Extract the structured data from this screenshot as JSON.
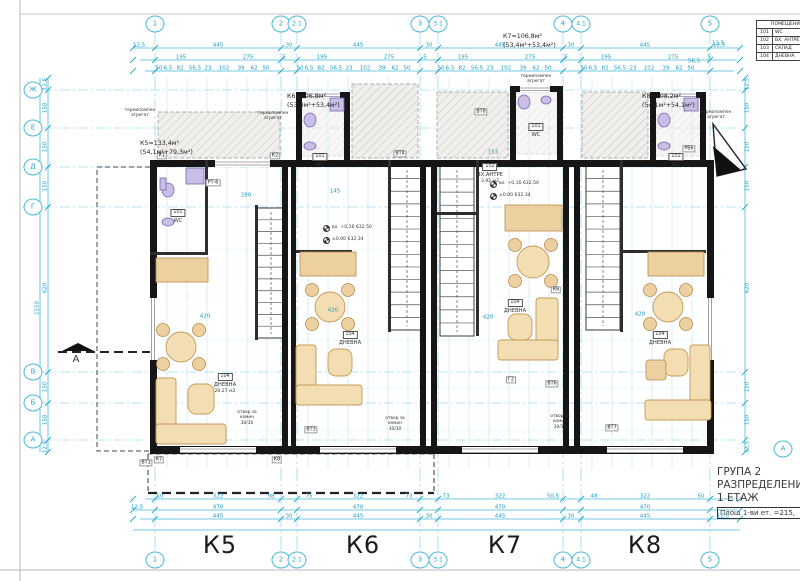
{
  "title_block": {
    "line1": "ГРУПА 2",
    "line2": "РАЗПРЕДЕЛЕНИЕ",
    "line3": "1 ЕТАЖ",
    "area_note": "Площ 1-ви ет. =215,",
    "section_letter": "А"
  },
  "legend": {
    "header": "ПОМЕЩЕНИЯ",
    "rows": [
      {
        "num": "101",
        "name": "WC"
      },
      {
        "num": "102",
        "name": "ВХ. АНТРЕ"
      },
      {
        "num": "103",
        "name": "СКЛАД"
      },
      {
        "num": "104",
        "name": "ДНЕВНА"
      }
    ]
  },
  "section_marker": {
    "letter": "А"
  },
  "units": [
    {
      "id": "К5",
      "label_x": 220,
      "label_y": 545,
      "area_line": "К5=133,4м²",
      "split_line": "(54,1м²+79,3м²)",
      "ann_x": 140,
      "ann_y": 139
    },
    {
      "id": "К6",
      "label_x": 363,
      "label_y": 545,
      "area_line": "К6=106,8м²",
      "split_line": "(53,4м²+53,4м²)",
      "ann_x": 287,
      "ann_y": 92
    },
    {
      "id": "К7",
      "label_x": 505,
      "label_y": 545,
      "area_line": "К7=106,8м²",
      "split_line": "(53,4м²+53,4м²)",
      "ann_x": 503,
      "ann_y": 32
    },
    {
      "id": "К8",
      "label_x": 645,
      "label_y": 545,
      "area_line": "К8=108,2м²",
      "split_line": "(54,1м²+54,1м²)",
      "ann_x": 642,
      "ann_y": 92
    }
  ],
  "axes": {
    "top": [
      {
        "label": "1",
        "x": 155
      },
      {
        "label": "2",
        "x": 281
      },
      {
        "label": "2.1",
        "x": 297
      },
      {
        "label": "3",
        "x": 420
      },
      {
        "label": "3.1",
        "x": 438
      },
      {
        "label": "4",
        "x": 563
      },
      {
        "label": "4.1",
        "x": 581
      },
      {
        "label": "5",
        "x": 710
      }
    ],
    "left": [
      {
        "label": "Ж",
        "y": 90
      },
      {
        "label": "Е",
        "y": 128
      },
      {
        "label": "Д",
        "y": 167
      },
      {
        "label": "Г",
        "y": 207
      },
      {
        "label": "В",
        "y": 372
      },
      {
        "label": "Б",
        "y": 403
      },
      {
        "label": "А",
        "y": 440
      }
    ]
  },
  "rooms": [
    {
      "x": 225,
      "y": 362,
      "num": "104",
      "name": "ДНЕВНА",
      "area": "26,27 м2"
    },
    {
      "x": 350,
      "y": 320,
      "num": "104",
      "name": "ДНЕВНА",
      "area": ""
    },
    {
      "x": 515,
      "y": 288,
      "num": "104",
      "name": "ДНЕВНА",
      "area": ""
    },
    {
      "x": 660,
      "y": 320,
      "num": "104",
      "name": "ДНЕВНА",
      "area": ""
    },
    {
      "x": 490,
      "y": 152,
      "num": "102",
      "name": "ВХ.АНТРЕ",
      "area": "3,92 м2"
    },
    {
      "x": 320,
      "y": 142,
      "num": "101",
      "name": "WC",
      "area": ""
    },
    {
      "x": 536,
      "y": 112,
      "num": "101",
      "name": "WC",
      "area": ""
    },
    {
      "x": 676,
      "y": 142,
      "num": "101",
      "name": "WC",
      "area": ""
    },
    {
      "x": 178,
      "y": 198,
      "num": "101",
      "name": "WC",
      "area": ""
    }
  ],
  "notes": [
    {
      "x": 247,
      "y": 410,
      "lines": [
        "отвор за",
        "комин",
        "30/30"
      ]
    },
    {
      "x": 395,
      "y": 416,
      "lines": [
        "отвор за",
        "комин",
        "30/30"
      ]
    },
    {
      "x": 560,
      "y": 414,
      "lines": [
        "отвор за",
        "комин",
        "30/30"
      ]
    },
    {
      "x": 140,
      "y": 108,
      "lines": [
        "термопомпен",
        "агрегат"
      ]
    },
    {
      "x": 273,
      "y": 111,
      "lines": [
        "термопомпен",
        "агрегат"
      ]
    },
    {
      "x": 536,
      "y": 74,
      "lines": [
        "термопомпен",
        "агрегат"
      ]
    },
    {
      "x": 716,
      "y": 110,
      "lines": [
        "термопомпен",
        "агрегат"
      ]
    }
  ],
  "elevations": [
    {
      "x": 323,
      "y": 225,
      "t": "вх. +0,16  632,50"
    },
    {
      "x": 323,
      "y": 237,
      "t": "±0,00  632,34"
    },
    {
      "x": 490,
      "y": 181,
      "t": "вх. +0,16  632,50"
    },
    {
      "x": 490,
      "y": 193,
      "t": "±0,00  632,34"
    }
  ],
  "tags": [
    {
      "t": "К1",
      "x": 162,
      "y": 156
    },
    {
      "t": "К2",
      "x": 275,
      "y": 156
    },
    {
      "t": "К6",
      "x": 556,
      "y": 290
    },
    {
      "t": "К7",
      "x": 159,
      "y": 460
    },
    {
      "t": "К8",
      "x": 277,
      "y": 460
    },
    {
      "t": "ВТ1",
      "x": 146,
      "y": 463
    },
    {
      "t": "ВТ3",
      "x": 311,
      "y": 430
    },
    {
      "t": "ВТ4",
      "x": 400,
      "y": 154
    },
    {
      "t": "ВТ6",
      "x": 552,
      "y": 384
    },
    {
      "t": "ВТ7",
      "x": 612,
      "y": 428
    },
    {
      "t": "ВТ8",
      "x": 481,
      "y": 112
    },
    {
      "t": "РБ6",
      "x": 689,
      "y": 149
    },
    {
      "t": "РТ-6",
      "x": 213,
      "y": 183
    },
    {
      "t": "Г2",
      "x": 511,
      "y": 380
    }
  ],
  "dims": [
    [
      "12,5",
      139,
      46
    ],
    [
      "445",
      218,
      46
    ],
    [
      "30",
      289,
      46
    ],
    [
      "445",
      358,
      46
    ],
    [
      "30",
      429,
      46
    ],
    [
      "445",
      500,
      46
    ],
    [
      "30",
      571,
      46
    ],
    [
      "445",
      645,
      46
    ],
    [
      "12,5",
      719,
      46
    ],
    [
      "195",
      181,
      58
    ],
    [
      "275",
      248,
      58
    ],
    [
      "5",
      284,
      58
    ],
    [
      "195",
      322,
      58
    ],
    [
      "275",
      389,
      58
    ],
    [
      "5",
      425,
      58
    ],
    [
      "195",
      463,
      58
    ],
    [
      "275",
      530,
      58
    ],
    [
      "5",
      566,
      58
    ],
    [
      "195",
      606,
      58
    ],
    [
      "275",
      673,
      58
    ],
    [
      "5",
      709,
      58
    ],
    [
      "50",
      159,
      69
    ],
    [
      "6,5",
      168,
      69
    ],
    [
      "82",
      180,
      69
    ],
    [
      "56,5",
      195,
      69
    ],
    [
      "23",
      208,
      69
    ],
    [
      "102",
      224,
      69
    ],
    [
      "39",
      241,
      69
    ],
    [
      "62",
      254,
      69
    ],
    [
      "50",
      266,
      69
    ],
    [
      "50",
      300,
      69
    ],
    [
      "6,5",
      309,
      69
    ],
    [
      "82",
      321,
      69
    ],
    [
      "56,5",
      336,
      69
    ],
    [
      "23",
      349,
      69
    ],
    [
      "102",
      365,
      69
    ],
    [
      "39",
      382,
      69
    ],
    [
      "62",
      395,
      69
    ],
    [
      "50",
      407,
      69
    ],
    [
      "50",
      441,
      69
    ],
    [
      "6,5",
      450,
      69
    ],
    [
      "82",
      462,
      69
    ],
    [
      "56,5",
      477,
      69
    ],
    [
      "23",
      490,
      69
    ],
    [
      "102",
      506,
      69
    ],
    [
      "39",
      523,
      69
    ],
    [
      "62",
      536,
      69
    ],
    [
      "50",
      548,
      69
    ],
    [
      "50",
      584,
      69
    ],
    [
      "6,5",
      593,
      69
    ],
    [
      "82",
      605,
      69
    ],
    [
      "56,5",
      620,
      69
    ],
    [
      "23",
      633,
      69
    ],
    [
      "102",
      649,
      69
    ],
    [
      "39",
      666,
      69
    ],
    [
      "62",
      679,
      69
    ],
    [
      "50",
      691,
      69
    ],
    [
      "50",
      160,
      497
    ],
    [
      "322",
      218,
      497
    ],
    [
      "98",
      271,
      497
    ],
    [
      "75",
      309,
      497
    ],
    [
      "322",
      358,
      497
    ],
    [
      "73",
      409,
      497
    ],
    [
      "73",
      446,
      497
    ],
    [
      "322",
      500,
      497
    ],
    [
      "50,5",
      553,
      497
    ],
    [
      "48",
      594,
      497
    ],
    [
      "322",
      645,
      497
    ],
    [
      "50",
      701,
      497
    ],
    [
      "12,5",
      137,
      508
    ],
    [
      "470",
      218,
      508
    ],
    [
      "470",
      358,
      508
    ],
    [
      "470",
      500,
      508
    ],
    [
      "470",
      645,
      508
    ],
    [
      "445",
      218,
      517
    ],
    [
      "30",
      289,
      517
    ],
    [
      "445",
      358,
      517
    ],
    [
      "30",
      429,
      517
    ],
    [
      "445",
      500,
      517
    ],
    [
      "30",
      571,
      517
    ],
    [
      "445",
      645,
      517
    ],
    [
      "12,5",
      723,
      517
    ],
    [
      "12,5",
      46,
      84,
      1
    ],
    [
      "150",
      46,
      108,
      1
    ],
    [
      "150",
      46,
      147,
      1
    ],
    [
      "150",
      46,
      186,
      1
    ],
    [
      "620",
      46,
      288,
      1
    ],
    [
      "150",
      46,
      387,
      1
    ],
    [
      "150",
      46,
      420,
      1
    ],
    [
      "12,5",
      46,
      447,
      1
    ],
    [
      "1150",
      38,
      308,
      1
    ],
    [
      "12,5",
      748,
      84,
      1
    ],
    [
      "150",
      748,
      108,
      1
    ],
    [
      "150",
      748,
      147,
      1
    ],
    [
      "150",
      748,
      186,
      1
    ],
    [
      "620",
      748,
      288,
      1
    ],
    [
      "150",
      748,
      387,
      1
    ],
    [
      "150",
      748,
      420,
      1
    ],
    [
      "12,5",
      748,
      447,
      1
    ],
    [
      "12,5",
      718,
      44
    ],
    [
      "56,5",
      694,
      62
    ],
    [
      "420",
      205,
      317
    ],
    [
      "420",
      333,
      311
    ],
    [
      "420",
      488,
      318
    ],
    [
      "420",
      640,
      315
    ],
    [
      "280",
      246,
      196
    ],
    [
      "153",
      493,
      153
    ],
    [
      "145",
      335,
      192
    ]
  ],
  "stairs": [
    {
      "x": 257,
      "y": 208,
      "w": 28,
      "h": 130,
      "n": 11
    },
    {
      "x": 390,
      "y": 166,
      "w": 34,
      "h": 164,
      "n": 13
    },
    {
      "x": 440,
      "y": 166,
      "w": 34,
      "h": 170,
      "n": 13
    },
    {
      "x": 586,
      "y": 166,
      "w": 34,
      "h": 164,
      "n": 13
    }
  ]
}
